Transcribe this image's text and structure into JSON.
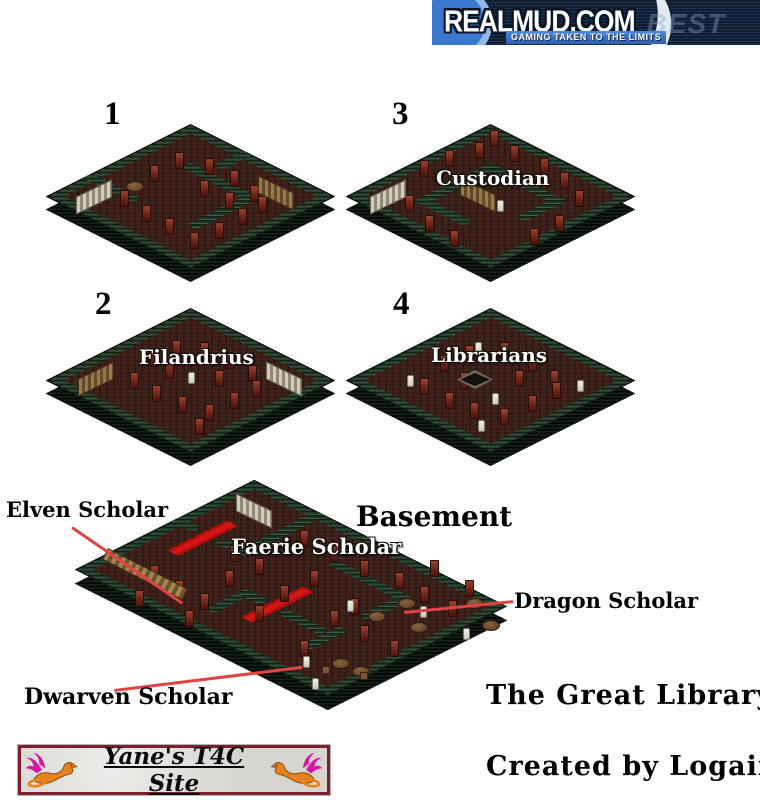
{
  "banner": {
    "title": "REALMUD.COM",
    "tagline": "GAMING TAKEN TO THE LIMITS",
    "ghost_text": "TS BEST",
    "accent_color": "#3a77cf"
  },
  "maps": {
    "m1": {
      "number": "1"
    },
    "m2": {
      "number": "2",
      "label": "Filandrius"
    },
    "m3": {
      "number": "3",
      "label": "Custodian"
    },
    "m4": {
      "number": "4",
      "label": "Librarians"
    }
  },
  "basement": {
    "title": "Basement",
    "faerie_label": "Faerie Scholar",
    "elven_label": "Elven Scholar",
    "dragon_label": "Dragon Scholar",
    "dwarven_label": "Dwarven Scholar"
  },
  "footer": {
    "map_title": "The Great Library",
    "credit": "Created by Logain"
  },
  "site_banner": {
    "text": "Yane's T4C Site"
  },
  "colors": {
    "wall_green": "#3f6046",
    "floor_brown": "#39201a",
    "shelf_red": "#6e2517",
    "carpet_red": "#c51212",
    "annotation_red": "#e04343",
    "banner_navy": "#101d31",
    "site_banner_border": "#7d1f2d"
  }
}
